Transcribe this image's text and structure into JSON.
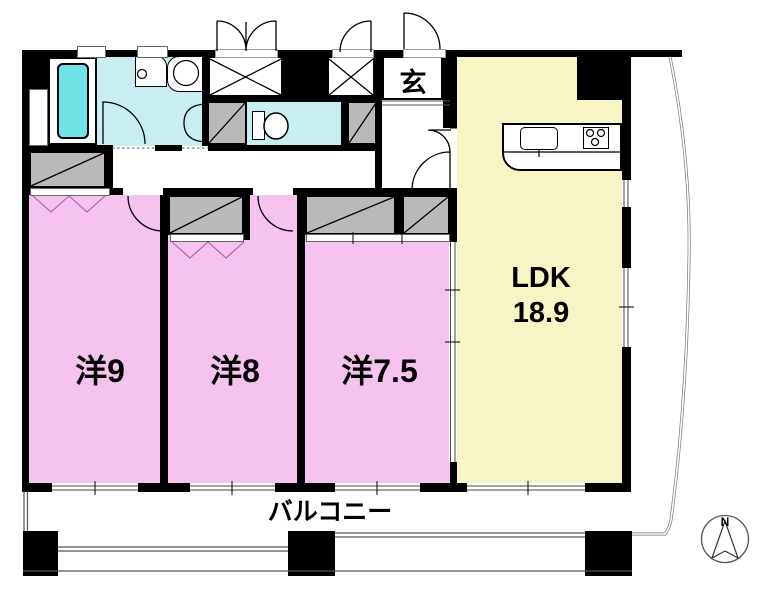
{
  "floorplan": {
    "type": "japanese-apartment-floor-plan",
    "rooms": {
      "western_9": {
        "label": "洋9"
      },
      "western_8": {
        "label": "洋8"
      },
      "western_7_5": {
        "label": "洋7.5"
      },
      "ldk": {
        "label": "LDK",
        "size": "18.9"
      },
      "entrance": {
        "label": "玄"
      },
      "balcony": {
        "label": "バルコニー"
      }
    },
    "compass": {
      "north_label": "N"
    },
    "fixtures": [
      "bathtub",
      "washing-machine-pan",
      "vanity-basin",
      "toilet",
      "kitchen-sink",
      "stove-burners",
      "closet",
      "shoe-box"
    ],
    "colors": {
      "room_pink": "#f6c3ee",
      "ldk_yellow": "#f8f5c5",
      "wet_area_cyan": "#c9eef2",
      "bathtub_cyan": "#6fe3e8",
      "closet_gray": "#b9b9b9",
      "wall_black": "#000000"
    }
  }
}
